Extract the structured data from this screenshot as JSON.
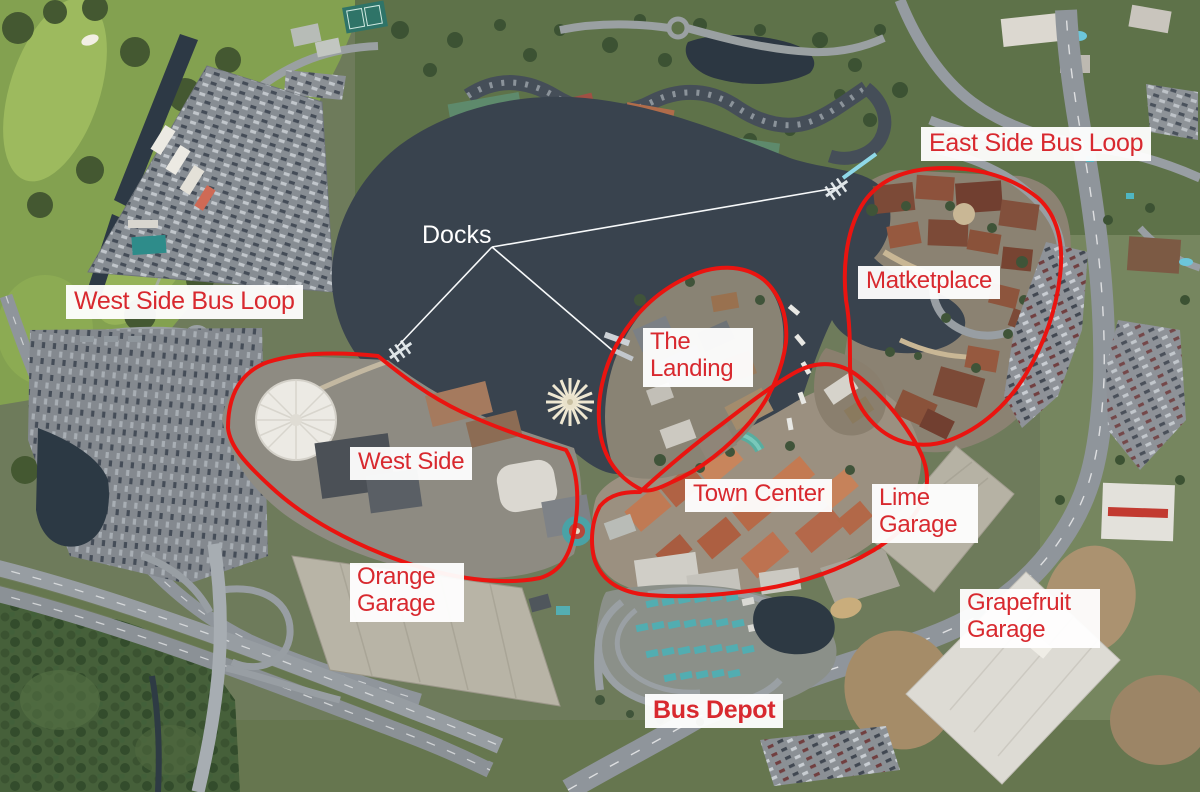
{
  "labels": {
    "east_side_bus_loop": "East Side Bus Loop",
    "west_side_bus_loop": "West Side Bus Loop",
    "marketplace": "Matketplace",
    "docks": "Docks",
    "the_landing": "The Landing",
    "west_side": "West Side",
    "town_center": "Town Center",
    "lime_garage": "Lime Garage",
    "orange_garage": "Orange Garage",
    "grapefruit_garage": "Grapefruit Garage",
    "bus_depot": "Bus Depot"
  },
  "annotation_style": {
    "label_text_color": "#d8292f",
    "label_background": "#ffffff",
    "area_outline_color": "#ea1410",
    "docks_text_color": "#ffffff",
    "leader_line_color": "#f7f9fa",
    "water_color": "#39434e"
  },
  "annotations": {
    "outlined_areas": [
      "West Side",
      "The Landing",
      "Town Center",
      "Matketplace"
    ],
    "dock_markers": 3
  }
}
